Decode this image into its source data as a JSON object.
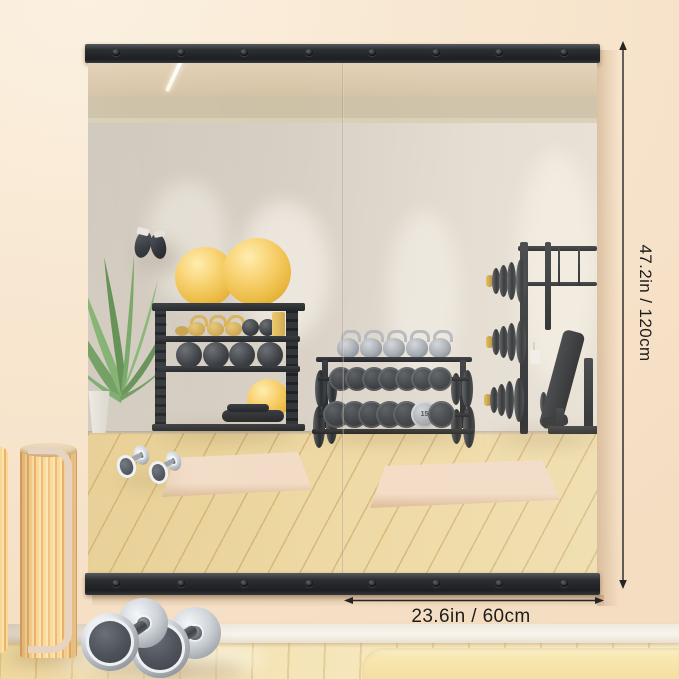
{
  "annotations": {
    "height_label": "47.2in / 120cm",
    "width_label": "23.6in / 60cm"
  },
  "reflection": {
    "plate_weight_label": "15"
  },
  "colors": {
    "wall": "#f7e4cd",
    "mirror_frame_strip": "#2b2e31",
    "reflected_wall": "#d9d1c6",
    "reflected_ceiling": "#dcc9ad",
    "reflected_floor_wood": "#ecd59c",
    "foreground_floor_wood": "#f3e2b0",
    "yoga_mat": "#eed5bc",
    "exercise_ball_yellow": "#f2c14e",
    "gold_kettlebell": "#d8b05e",
    "annotation_ink": "#1d1d1d",
    "baseboard": "#f6f2e9",
    "wood_roller": "#f6cf8d"
  }
}
